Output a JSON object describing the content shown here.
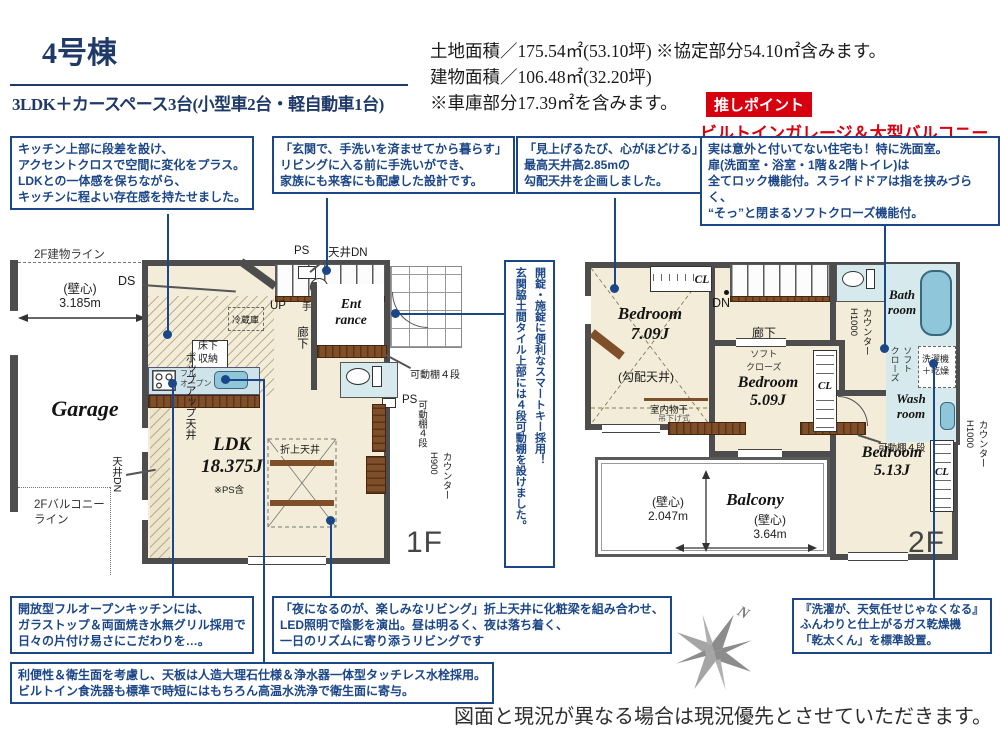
{
  "colors": {
    "navy": "#1b4687",
    "title_navy": "#1f3a68",
    "red": "#d7000f",
    "beige": "#f2ecd8",
    "wet_blue": "#d6e9ec",
    "fixture_blue": "#8fc6d9",
    "wall_gray": "#4d4d4d",
    "wood_brown": "#7b4a28"
  },
  "header": {
    "building": "4号棟",
    "layout": "3LDK＋カースペース3台(小型車2台・軽自動車1台)"
  },
  "info": {
    "land": "土地面積／175.54㎡(53.10坪) ※協定部分54.10㎡含みます。",
    "building": "建物面積／106.48㎡(32.20坪)",
    "garage": "※車庫部分17.39㎡を含みます。",
    "badge": "推しポイント",
    "highlight": "ビルトインガレージ＆大型バルコニープラン"
  },
  "callouts": {
    "kitchen_upper": "キッチン上部に段差を設け、\nアクセントクロスで空間に変化をプラス。\nLDKとの一体感を保ちながら、\nキッチンに程よい存在感を持たせました。",
    "entrance_wash": "「玄関で、手洗いを済ませてから暮らす」\nリビングに入る前に手洗いができ、\n家族にも来客にも配慮した設計です。",
    "sloped_ceiling": "「見上げるたび、心がほどける」\n最高天井高2.85mの\n勾配天井を企画しました。",
    "door_lock": "実は意外と付いてない住宅も！特に洗面室。\n扉(洗面室・浴室・1階＆2階トイレ)は\n全てロック機能付。スライドドアは指を挟みづらく、\n“そっ”と閉まるソフトクローズ機能付。",
    "smart_key": "開錠・施錠に便利なスマートキー採用！\n玄関脇土間タイル上部には４段可動棚を設けました。",
    "open_kitchen": "開放型フルオープンキッチンには、\nガラストップ＆両面焼き水無グリル採用で\n日々の片付け易さにこだわりを…。",
    "living": "「夜になるのが、楽しみなリビング」折上天井に化粧梁を組み合わせ、\nLED照明で陰影を演出。昼は明るく、夜は落ち着く、\n一日のリズムに寄り添うリビングです",
    "counter_top": "利便性＆衛生面を考慮し、天板は人造大理石仕様＆浄水器一体型タッチレス水栓採用。\nビルトイン食洗器も標準で時短にはもちろん高温水洗浄で衛生面に寄与。",
    "gas_dryer": "『洗濯が、天気任せじゃなくなる』\nふんわりと仕上がるガス乾燥機\n「乾太くん」を標準設置。"
  },
  "plan1f": {
    "floor": "1F",
    "garage": "Garage",
    "building_line": "2F建物ライン",
    "balcony_line": "2Fバルコニー\nライン",
    "dim_width": "(壁心)\n3.185m",
    "ds": "DS",
    "up": "UP",
    "ps": "PS",
    "ceiling_dn_h": "天井DN",
    "ceiling_dn_v": "天井DN",
    "handwash": "手洗器",
    "corridor": "廊下",
    "entrance": "Ent\nrance",
    "shelf": "可動棚４段",
    "fridge": "冷蔵庫",
    "underfloor": "床下\n収納",
    "full_open": "フル\nオープン",
    "popup": "ポップアップ天井",
    "ldk": "LDK\n18.375J",
    "ldk_note": "※PS含",
    "folded": "折上天井",
    "counter": "カウンター\nH900"
  },
  "plan2f": {
    "floor": "2F",
    "bedroom1": "Bedroom\n7.09J",
    "sloped": "(勾配天井)",
    "cl": "CL",
    "dn": "DN",
    "corridor": "廊下",
    "drying": "室内物干",
    "drying_type": "吊下げ式",
    "soft_close": "ソフト\nクローズ",
    "counter1000": "カウンター\nH1000",
    "bath": "Bath\nroom",
    "wash": "Wash\nroom",
    "washer": "洗濯機\n＋乾燥",
    "bedroom2": "Bedroom\n5.09J",
    "bedroom3": "Bedroom\n5.13J",
    "balcony": "Balcony",
    "dim_v": "(壁心)\n2.047m",
    "dim_h": "(壁心)\n3.64m",
    "shelf": "可動棚４段"
  },
  "compass": {
    "north": "N"
  },
  "disclaimer": "図面と現況が異なる場合は現況優先とさせていただきます。"
}
